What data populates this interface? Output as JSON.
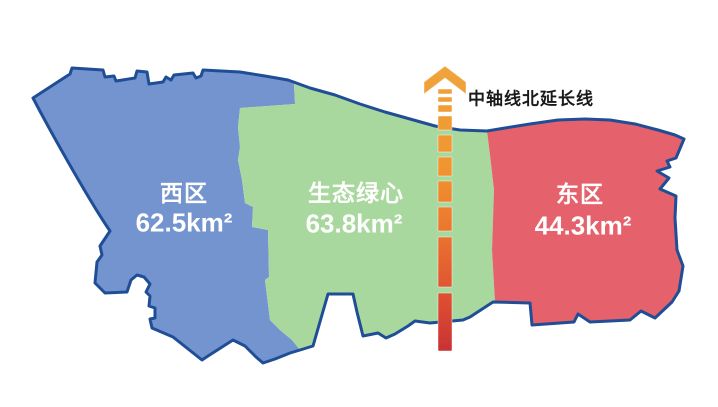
{
  "map": {
    "title_context": "district area map",
    "outline_color": "#1F4E96",
    "regions": [
      {
        "id": "west",
        "name": "西区",
        "area": "62.5km²",
        "color": "#7394CF"
      },
      {
        "id": "green",
        "name": "生态绿心",
        "area": "63.8km²",
        "color": "#A9D89E"
      },
      {
        "id": "east",
        "name": "东区",
        "area": "44.3km²",
        "color": "#E5616C"
      }
    ],
    "axis": {
      "label": "中轴线北延长线",
      "arrow_color": "#F0A43C",
      "gradient_top": "#F0A43C",
      "gradient_mid": "#EC7A2E",
      "gradient_bottom": "#C93134"
    }
  }
}
